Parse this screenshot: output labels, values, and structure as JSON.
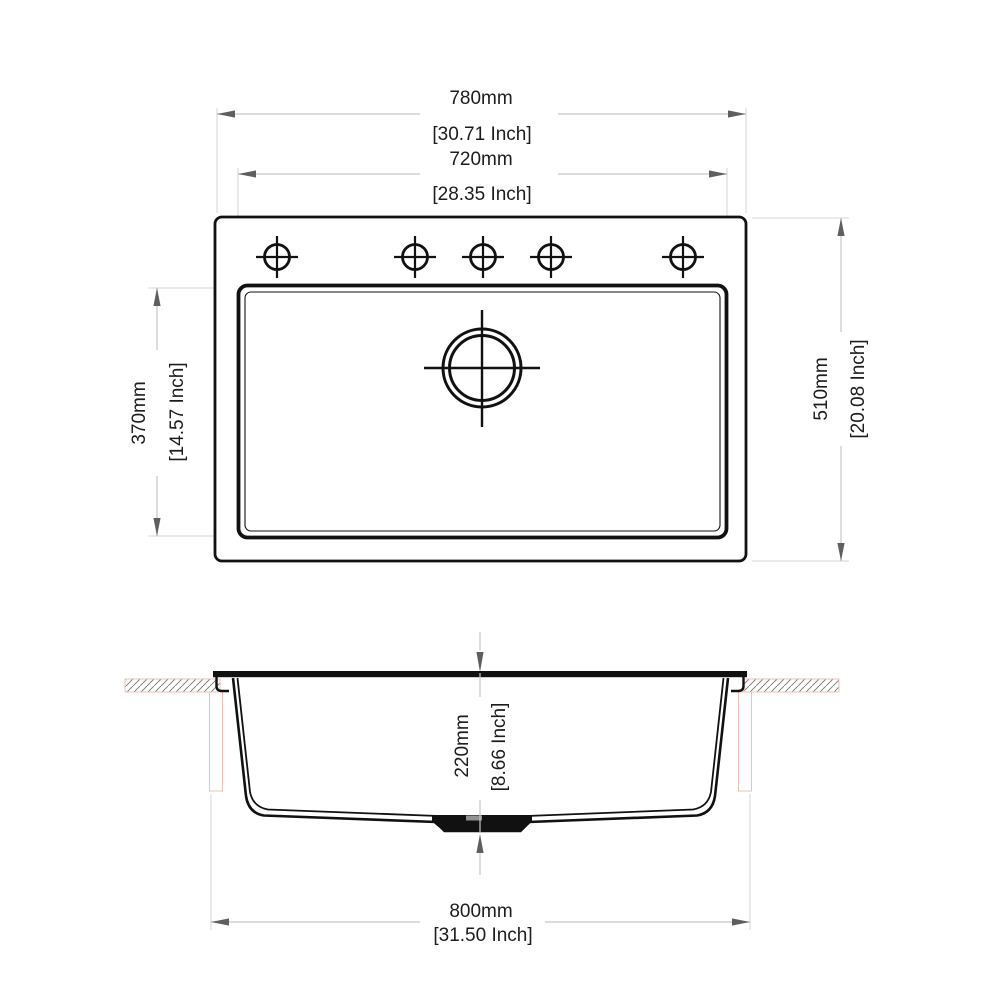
{
  "title": "Sink technical drawing with dimensions",
  "colors": {
    "background": "#ffffff",
    "drawing_line": "#111111",
    "dimension_line": "#c6c6c6",
    "extension_line": "#d4d4d4",
    "arrow": "#5f5f5f",
    "text": "#1c1c1c",
    "countertop_pink": "#eec0ba",
    "hatch_line": "#777777"
  },
  "symbols": {
    "faucet_hole": "crosshair-circle-marker",
    "drain": "double-circle-crosshair-marker",
    "countertop": "diagonal-hatch-section"
  },
  "top_view": {
    "faucet_hole_count": "5"
  },
  "dimensions": {
    "overall_width": {
      "mm": "780mm",
      "inch": "[30.71 Inch]"
    },
    "basin_width": {
      "mm": "720mm",
      "inch": "[28.35 Inch]"
    },
    "basin_depth": {
      "mm": "370mm",
      "inch": "[14.57 Inch]"
    },
    "overall_depth": {
      "mm": "510mm",
      "inch": "[20.08 Inch]"
    },
    "bowl_height": {
      "mm": "220mm",
      "inch": "[8.66 Inch]"
    },
    "bottom_width": {
      "mm": "800mm",
      "inch": "[31.50 Inch]"
    }
  }
}
